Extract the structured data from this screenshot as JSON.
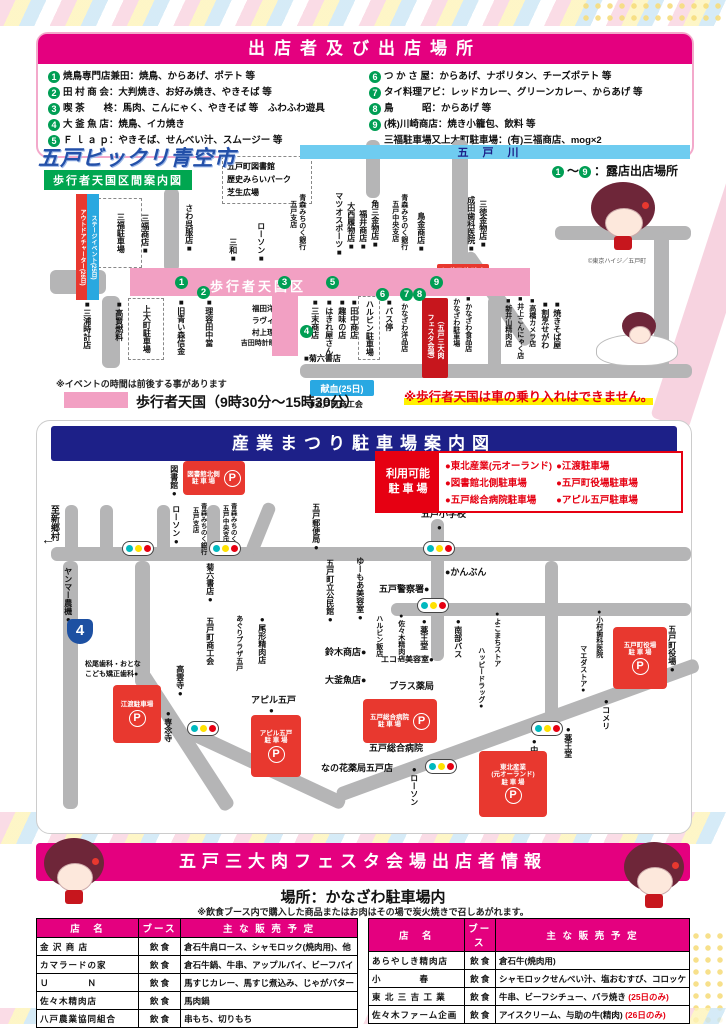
{
  "colors": {
    "accent_pink": "#E4007F",
    "navy": "#1D2088",
    "green_num": "#009E54",
    "red_box": "#E8382F",
    "legend_red": "#E60012",
    "river_blue": "#6FCCF0",
    "strip_pink": "#F2A0C3",
    "road_gray": "#B5B5B6"
  },
  "header": {
    "title": "出店者及び出店場所",
    "vendors_left": [
      {
        "num": "1",
        "text": "焼鳥専門店兼田：焼鳥、からあげ、ポテト 等"
      },
      {
        "num": "2",
        "text": "田 村 商 会：大判焼き、お好み焼き、やきそば 等"
      },
      {
        "num": "3",
        "text": "喫 茶　　柊：馬肉、こんにゃく、やきそば 等　ふわふわ遊具"
      },
      {
        "num": "4",
        "text": "大 釜 魚 店：焼鳥、イカ焼き"
      },
      {
        "num": "5",
        "text": "Ｆ ｌ ａ ｐ：やきそば、せんべい汁、スムージー 等"
      }
    ],
    "vendors_right": [
      {
        "num": "6",
        "text": "つ か さ 屋：からあげ、ナポリタン、チーズポテト 等"
      },
      {
        "num": "7",
        "text": "タイ料理アビ：レッドカレー、グリーンカレー、からあげ 等"
      },
      {
        "num": "8",
        "text": "鳥　　　昭：からあげ 等"
      },
      {
        "num": "9",
        "text": "(株)川崎商店：焼き小籠包、飲料 等"
      },
      {
        "num": "",
        "text": "三福駐車場又上大町駐車場：(有)三福商店、mog×2"
      }
    ]
  },
  "map1": {
    "title": "五戸ビックリ青空市",
    "subtitle": "歩行者天国区間案内図",
    "river_label": "五戸川",
    "walkzone_label": "歩行者天国区",
    "stall": {
      "n1": "1",
      "tilde": "～",
      "n9": "9",
      "rest": "：露店出店場所"
    },
    "copyright": "©東京ハイジ／五戸町",
    "note_time": "※イベントの時間は前後する事があります",
    "legend_strip": "歩行者天国（9時30分～15時30分）",
    "warning": "※歩行者天国は車の乗り入れはできません。",
    "roads": [
      {
        "x": 66,
        "y": 156,
        "w": 18,
        "h": 72
      },
      {
        "x": 14,
        "y": 130,
        "w": 56,
        "h": 24
      },
      {
        "x": 128,
        "y": 48,
        "w": 15,
        "h": 84
      },
      {
        "x": 416,
        "y": 0,
        "w": 16,
        "h": 130
      },
      {
        "x": 424,
        "y": 118,
        "w": 15,
        "h": 110,
        "rot": -35
      },
      {
        "x": 519,
        "y": 86,
        "w": 136,
        "h": 14
      },
      {
        "x": 618,
        "y": 92,
        "w": 15,
        "h": 140
      },
      {
        "x": 264,
        "y": 224,
        "w": 392,
        "h": 14
      },
      {
        "x": 452,
        "y": 156,
        "w": 13,
        "h": 82
      },
      {
        "x": 330,
        "y": 0,
        "w": 14,
        "h": 58
      }
    ],
    "strips": [
      {
        "x": 94,
        "y": 128,
        "w": 400,
        "h": 28
      },
      {
        "x": 236,
        "y": 128,
        "w": 26,
        "h": 88
      }
    ],
    "river": {
      "x": 264,
      "y": 5,
      "w": 390,
      "h": 14
    },
    "ribbons": [
      {
        "x": 40,
        "y": 54,
        "w": 10,
        "h": 102,
        "text": "アウトドアチャーター(26日)",
        "bg": "#E8382F"
      },
      {
        "x": 51,
        "y": 54,
        "w": 10,
        "h": 102,
        "text": "ステージイベント(25日)",
        "bg": "#29A8E0"
      }
    ],
    "zones": [
      {
        "x": 62,
        "y": 58,
        "w": 42,
        "h": 68,
        "label": "三福駐車場",
        "vertical": true
      },
      {
        "x": 186,
        "y": 16,
        "w": 88,
        "h": 46,
        "lines": [
          "五戸町図書館",
          "歴史みらいパーク",
          "芝生広場"
        ]
      },
      {
        "x": 92,
        "y": 158,
        "w": 34,
        "h": 60,
        "label": "上大町駐車場",
        "vertical": true
      },
      {
        "x": 322,
        "y": 156,
        "w": 20,
        "h": 62,
        "label": "ハルビン駐車場",
        "vertical": true
      }
    ],
    "boxes": [
      {
        "x": 100,
        "y": 132,
        "w": 64,
        "h": 22,
        "bg": "#00A650",
        "text": "青空カフェ",
        "fs": 10
      },
      {
        "x": 250,
        "y": 129,
        "w": 33,
        "h": 26,
        "bg": "#F08300",
        "lines": [
          "ふわふわ",
          "遊具"
        ],
        "fs": 7
      },
      {
        "x": 240,
        "y": 150,
        "w": 18,
        "h": 64,
        "bg": "#29A8E0",
        "text": "自衛隊車両展示(26日)",
        "vertical": true,
        "fs": 6
      },
      {
        "x": 401,
        "y": 124,
        "w": 52,
        "h": 26,
        "bg": "#E8382F",
        "lines": [
          "お囃子体験会",
          "(26日)"
        ],
        "fs": 7.5
      },
      {
        "x": 386,
        "y": 158,
        "w": 26,
        "h": 80,
        "bg": "#C7161D",
        "cols": [
          "（五戸三大肉",
          "フェスタ会場）"
        ],
        "fs": 7
      },
      {
        "x": 274,
        "y": 240,
        "w": 64,
        "h": 16,
        "bg": "#29A8E2",
        "text": "献血(25日)",
        "fs": 9
      }
    ],
    "numbers": [
      {
        "n": "1",
        "x": 139,
        "y": 136
      },
      {
        "n": "2",
        "x": 161,
        "y": 146
      },
      {
        "n": "3",
        "x": 242,
        "y": 136
      },
      {
        "n": "5",
        "x": 290,
        "y": 136
      },
      {
        "n": "6",
        "x": 340,
        "y": 148
      },
      {
        "n": "7",
        "x": 364,
        "y": 148
      },
      {
        "n": "8",
        "x": 377,
        "y": 148
      },
      {
        "n": "9",
        "x": 394,
        "y": 136
      },
      {
        "n": "4",
        "x": 264,
        "y": 185
      }
    ],
    "labels": [
      {
        "t": "三福商店■",
        "x": 104,
        "y": 74,
        "v": 1
      },
      {
        "t": "さわ呉服店■",
        "x": 148,
        "y": 64,
        "v": 1
      },
      {
        "t": "三和■",
        "x": 192,
        "y": 98,
        "v": 1
      },
      {
        "t": "ローソン■",
        "x": 220,
        "y": 82,
        "v": 1
      },
      {
        "t": "青森みちのく銀行",
        "x": 262,
        "y": 54,
        "v": 1,
        "fs": 7
      },
      {
        "t": "五戸支店",
        "x": 253,
        "y": 60,
        "v": 1,
        "fs": 7
      },
      {
        "t": "マツオスポーツ■",
        "x": 298,
        "y": 52,
        "v": 1
      },
      {
        "t": "大西履物店■",
        "x": 310,
        "y": 62,
        "v": 1
      },
      {
        "t": "福井商店■",
        "x": 322,
        "y": 70,
        "v": 1
      },
      {
        "t": "角三金物店■",
        "x": 334,
        "y": 60,
        "v": 1
      },
      {
        "t": "青森みちのく銀行",
        "x": 364,
        "y": 54,
        "v": 1,
        "fs": 7
      },
      {
        "t": "五戸中央支店",
        "x": 355,
        "y": 60,
        "v": 1,
        "fs": 7
      },
      {
        "t": "鳥金商店■",
        "x": 380,
        "y": 72,
        "v": 1
      },
      {
        "t": "成田歯科医院■",
        "x": 430,
        "y": 56,
        "v": 1
      },
      {
        "t": "三徳金物店■",
        "x": 442,
        "y": 60,
        "v": 1
      },
      {
        "t": "■三浦時計店",
        "x": 46,
        "y": 160,
        "v": 1
      },
      {
        "t": "■高賢燃料",
        "x": 78,
        "y": 160,
        "v": 1
      },
      {
        "t": "■旧青い森信金",
        "x": 140,
        "y": 158,
        "v": 1
      },
      {
        "t": "■理容田中當",
        "x": 168,
        "y": 158,
        "v": 1
      },
      {
        "t": "福田洋服店■",
        "x": 196,
        "y": 164,
        "w": 62,
        "align": "right",
        "fs": 7.5
      },
      {
        "t": "ラヴィール■",
        "x": 196,
        "y": 176,
        "w": 62,
        "align": "right",
        "fs": 7.5
      },
      {
        "t": "村上理髪店■",
        "x": 196,
        "y": 188,
        "w": 62,
        "align": "right",
        "fs": 7.5
      },
      {
        "t": "吉田時計眼鏡店■",
        "x": 196,
        "y": 200,
        "w": 62,
        "align": "right",
        "fs": 7
      },
      {
        "t": "■三末商店",
        "x": 274,
        "y": 158,
        "v": 1
      },
      {
        "t": "■はきれ屋さん",
        "x": 288,
        "y": 158,
        "v": 1
      },
      {
        "t": "■趣味の店",
        "x": 301,
        "y": 158,
        "v": 1
      },
      {
        "t": "■田中商店",
        "x": 313,
        "y": 158,
        "v": 1
      },
      {
        "t": "■バス停",
        "x": 348,
        "y": 158,
        "v": 1
      },
      {
        "t": "■かなざわ洋品店",
        "x": 364,
        "y": 156,
        "v": 1,
        "fs": 7
      },
      {
        "t": "■菊六書店",
        "x": 268,
        "y": 214
      },
      {
        "t": "かなざわ駐車場",
        "x": 416,
        "y": 158,
        "v": 1,
        "fs": 7
      },
      {
        "t": "■かなざわ食品店",
        "x": 428,
        "y": 156,
        "v": 1,
        "fs": 7
      },
      {
        "t": "■新井山精肉店",
        "x": 468,
        "y": 158,
        "v": 1,
        "fs": 7
      },
      {
        "t": "■井上こんにゃく店",
        "x": 480,
        "y": 156,
        "v": 1,
        "fs": 7
      },
      {
        "t": "■高橋カメラ店",
        "x": 492,
        "y": 158,
        "v": 1,
        "fs": 7
      },
      {
        "t": "■割烹せがわ",
        "x": 504,
        "y": 160,
        "v": 1
      },
      {
        "t": "■焼きそば屋",
        "x": 516,
        "y": 160,
        "v": 1
      },
      {
        "t": "■五戸町商工会",
        "x": 274,
        "y": 260
      }
    ]
  },
  "map2": {
    "title": "産業まつり駐車場案内図",
    "legend_label_1": "利用可能",
    "legend_label_2": "駐 車 場",
    "legend_col1": [
      "●東北産業(元オーランド)",
      "●図書館北側駐車場",
      "●五戸総合病院駐車場"
    ],
    "legend_col2": [
      "●江渡駐車場",
      "●五戸町役場駐車場",
      "●アピル五戸駐車場"
    ],
    "shield_label": "4",
    "roads": [
      {
        "x": 14,
        "y": 126,
        "w": 640,
        "h": 14
      },
      {
        "x": 354,
        "y": 182,
        "w": 300,
        "h": 13
      },
      {
        "x": 394,
        "y": 98,
        "w": 13,
        "h": 142
      },
      {
        "x": 508,
        "y": 140,
        "w": 13,
        "h": 168
      },
      {
        "x": 28,
        "y": 84,
        "w": 13,
        "h": 48
      },
      {
        "x": 63,
        "y": 84,
        "w": 13,
        "h": 48
      },
      {
        "x": 120,
        "y": 84,
        "w": 13,
        "h": 48
      },
      {
        "x": 170,
        "y": 84,
        "w": 13,
        "h": 48
      },
      {
        "x": 228,
        "y": 80,
        "w": 13,
        "h": 54,
        "rot": 22
      },
      {
        "x": 26,
        "y": 140,
        "w": 15,
        "h": 248
      },
      {
        "x": 98,
        "y": 140,
        "w": 15,
        "h": 126
      },
      {
        "x": 98,
        "y": 256,
        "w": 15,
        "h": 162,
        "rot": -33
      },
      {
        "x": 158,
        "y": 306,
        "w": 168,
        "h": 14,
        "rot": 25
      },
      {
        "x": 298,
        "y": 368,
        "w": 384,
        "h": 14,
        "rot": -20
      }
    ],
    "lights": [
      {
        "x": 85,
        "y": 120
      },
      {
        "x": 172,
        "y": 120
      },
      {
        "x": 386,
        "y": 120
      },
      {
        "x": 380,
        "y": 177
      },
      {
        "x": 150,
        "y": 300
      },
      {
        "x": 388,
        "y": 338
      },
      {
        "x": 494,
        "y": 300
      }
    ],
    "parkings": [
      {
        "x": 146,
        "y": 40,
        "w": 58,
        "h": 30,
        "lines": [
          "図書館北側",
          "駐 車 場"
        ],
        "side": 1
      },
      {
        "x": 576,
        "y": 206,
        "w": 50,
        "h": 58,
        "lines": [
          "五戸町役場",
          "駐 車 場"
        ]
      },
      {
        "x": 76,
        "y": 264,
        "w": 44,
        "h": 54,
        "lines": [
          "江渡駐車場"
        ]
      },
      {
        "x": 214,
        "y": 294,
        "w": 46,
        "h": 58,
        "lines": [
          "アピル五戸",
          "駐 車 場"
        ]
      },
      {
        "x": 326,
        "y": 278,
        "w": 70,
        "h": 40,
        "lines": [
          "五戸総合病院",
          "駐 車 場"
        ],
        "side": 1
      },
      {
        "x": 442,
        "y": 330,
        "w": 64,
        "h": 62,
        "lines": [
          "東北産業",
          "(元オーランド)",
          "駐 車 場"
        ]
      }
    ],
    "labels": [
      {
        "t": "至新郷村",
        "x": 12,
        "y": 84,
        "v": 1,
        "fs": 9
      },
      {
        "t": "←",
        "x": 4,
        "y": 110,
        "fs": 14
      },
      {
        "t": "図書館●",
        "x": 132,
        "y": 44,
        "v": 1
      },
      {
        "t": "ローソン●",
        "x": 134,
        "y": 84,
        "v": 1
      },
      {
        "t": "青森みちのく銀行",
        "x": 162,
        "y": 82,
        "v": 1,
        "fs": 6.5
      },
      {
        "t": "五戸支店",
        "x": 154,
        "y": 86,
        "v": 1,
        "fs": 6.5
      },
      {
        "t": "青森みちのく銀行",
        "x": 192,
        "y": 82,
        "v": 1,
        "fs": 6.5
      },
      {
        "t": "五戸中央支店",
        "x": 184,
        "y": 84,
        "v": 1,
        "fs": 6.5
      },
      {
        "t": "五戸郵便局●",
        "x": 274,
        "y": 82,
        "v": 1
      },
      {
        "t": "五戸小学校",
        "x": 384,
        "y": 88,
        "fs": 9
      },
      {
        "t": "●",
        "x": 400,
        "y": 102,
        "fs": 8
      },
      {
        "t": "ヤンマー農機●",
        "x": 26,
        "y": 146,
        "v": 1
      },
      {
        "t": "菊六書店●",
        "x": 168,
        "y": 142,
        "v": 1
      },
      {
        "t": "五戸町立公民館●",
        "x": 288,
        "y": 138,
        "v": 1
      },
      {
        "t": "ゆーもあ美容室●",
        "x": 318,
        "y": 136,
        "v": 1
      },
      {
        "t": "●かんぶん",
        "x": 408,
        "y": 146,
        "fs": 9
      },
      {
        "t": "五戸警察署●",
        "x": 342,
        "y": 163,
        "fs": 9
      },
      {
        "t": "五戸町商工会",
        "x": 168,
        "y": 196,
        "v": 1
      },
      {
        "t": "あぐりプラザ五戸",
        "x": 198,
        "y": 194,
        "v": 1,
        "fs": 7
      },
      {
        "t": "●尾形精肉店",
        "x": 220,
        "y": 194,
        "v": 1
      },
      {
        "t": "鈴木商店●",
        "x": 288,
        "y": 226,
        "fs": 9
      },
      {
        "t": "大釜魚店●",
        "x": 288,
        "y": 254,
        "fs": 9
      },
      {
        "t": "ハルビン飯店",
        "x": 338,
        "y": 194,
        "v": 1,
        "fs": 7
      },
      {
        "t": "エコー美容室●",
        "x": 344,
        "y": 234,
        "fs": 8
      },
      {
        "t": "プラス薬局",
        "x": 352,
        "y": 260,
        "fs": 9
      },
      {
        "t": "五戸総合病院",
        "x": 332,
        "y": 322,
        "fs": 9
      },
      {
        "t": "なの花薬局五戸店",
        "x": 284,
        "y": 342,
        "fs": 9
      },
      {
        "t": "松尾歯科・おとな",
        "x": 48,
        "y": 240,
        "fs": 7
      },
      {
        "t": "こども矯正歯科●",
        "x": 48,
        "y": 250,
        "fs": 7
      },
      {
        "t": "高雲寺●",
        "x": 138,
        "y": 244,
        "v": 1
      },
      {
        "t": "●専念寺",
        "x": 126,
        "y": 288,
        "v": 1
      },
      {
        "t": "アピル五戸",
        "x": 214,
        "y": 274,
        "fs": 9
      },
      {
        "t": "●",
        "x": 232,
        "y": 285,
        "fs": 8
      },
      {
        "t": "●佐々木精肉店",
        "x": 360,
        "y": 192,
        "v": 1,
        "fs": 7
      },
      {
        "t": "●薬王堂",
        "x": 382,
        "y": 196,
        "v": 1
      },
      {
        "t": "●南部バス",
        "x": 416,
        "y": 196,
        "v": 1
      },
      {
        "t": "●よこまちストア",
        "x": 456,
        "y": 190,
        "v": 1,
        "fs": 7
      },
      {
        "t": "ハッピードラッグ●",
        "x": 440,
        "y": 226,
        "v": 1,
        "fs": 7
      },
      {
        "t": "●小村歯科医院",
        "x": 558,
        "y": 188,
        "v": 1,
        "fs": 7
      },
      {
        "t": "マエダストア●",
        "x": 542,
        "y": 224,
        "v": 1,
        "fs": 7
      },
      {
        "t": "●コメリ",
        "x": 564,
        "y": 276,
        "v": 1
      },
      {
        "t": "●薬王堂",
        "x": 526,
        "y": 304,
        "v": 1
      },
      {
        "t": "●中里石油",
        "x": 492,
        "y": 316,
        "v": 1
      },
      {
        "t": "●ローソン",
        "x": 372,
        "y": 344,
        "v": 1
      },
      {
        "t": "五戸町役場●",
        "x": 630,
        "y": 204,
        "v": 1
      }
    ]
  },
  "festa": {
    "title": "五戸三大肉フェスタ会場出店者情報",
    "place": "場所：かなざわ駐車場内",
    "note": "※飲食ブース内で購入した商品またはお肉はその場で炭火焼きで召しあがれます。",
    "headers": [
      "店　名",
      "ブース",
      "主 な 販 売 予 定"
    ],
    "left_rows": [
      {
        "name": "金 沢 商 店",
        "booth": "飲 食",
        "items": "倉石牛肩ロース、シャモロック(焼肉用)、他",
        "note": ""
      },
      {
        "name": "カマラードの家",
        "booth": "飲 食",
        "items": "倉石牛鍋、牛串、アップルパイ、ビーフパイ",
        "note": ""
      },
      {
        "name": "Ｕ　　　　Ｎ",
        "booth": "飲 食",
        "items": "馬すじカレー、馬すじ煮込み、じゃがバター",
        "note": ""
      },
      {
        "name": "佐々木精肉店",
        "booth": "飲 食",
        "items": "馬肉鍋",
        "note": ""
      },
      {
        "name": "八戸農業協同組合",
        "booth": "飲 食",
        "items": "串もち、切りもち",
        "note": ""
      }
    ],
    "right_rows": [
      {
        "name": "あらやしき精肉店",
        "booth": "飲 食",
        "items": "倉石牛(焼肉用)",
        "note": ""
      },
      {
        "name": "小　　　　春",
        "booth": "飲 食",
        "items": "シャモロックせんべい汁、塩おむすび、コロッケ",
        "note": ""
      },
      {
        "name": "東 北 三 吉 工 業",
        "booth": "飲 食",
        "items": "牛串、ビーフシチュー、バラ焼き ",
        "note": "(25日のみ)"
      },
      {
        "name": "佐々木ファーム企画",
        "booth": "飲 食",
        "items": "アイスクリーム、与助の牛(精肉) ",
        "note": "(26日のみ)"
      }
    ]
  }
}
